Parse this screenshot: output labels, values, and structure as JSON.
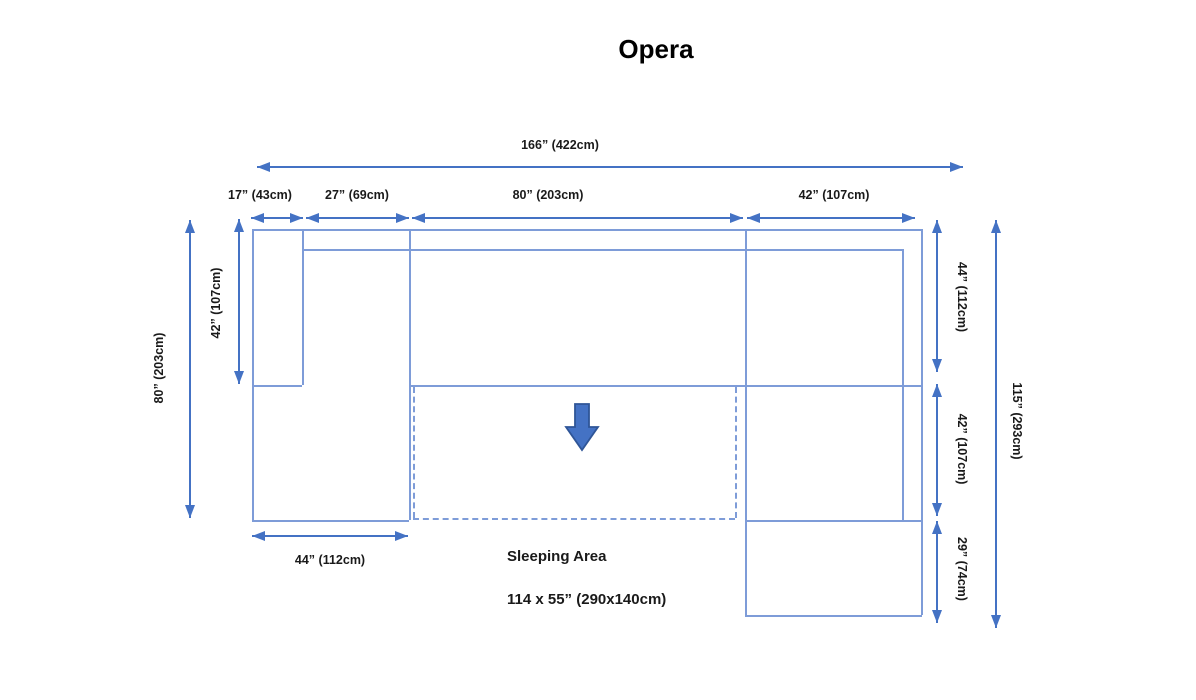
{
  "title": "Opera",
  "dims": {
    "total_width": "166” (422cm)",
    "left_arm_width": "17” (43cm)",
    "left_chaise_width": "27” (69cm)",
    "center_width": "80” (203cm)",
    "right_width": "42” (107cm)",
    "left_total_height": "80” (203cm)",
    "left_arm_height": "42” (107cm)",
    "right_back_height": "44” (112cm)",
    "right_mid_height": "42” (107cm)",
    "right_chaise_height": "29” (74cm)",
    "total_height": "115” (293cm)",
    "bottom_chaise_width": "44” (112cm)"
  },
  "sleeping_area": {
    "label": "Sleeping Area",
    "size": "114 x 55” (290x140cm)"
  },
  "colors": {
    "accent": "#4472c4",
    "sofa_outline": "#7e9cd8",
    "block_arrow_fill": "#4472c4",
    "block_arrow_border": "#2f5597"
  }
}
